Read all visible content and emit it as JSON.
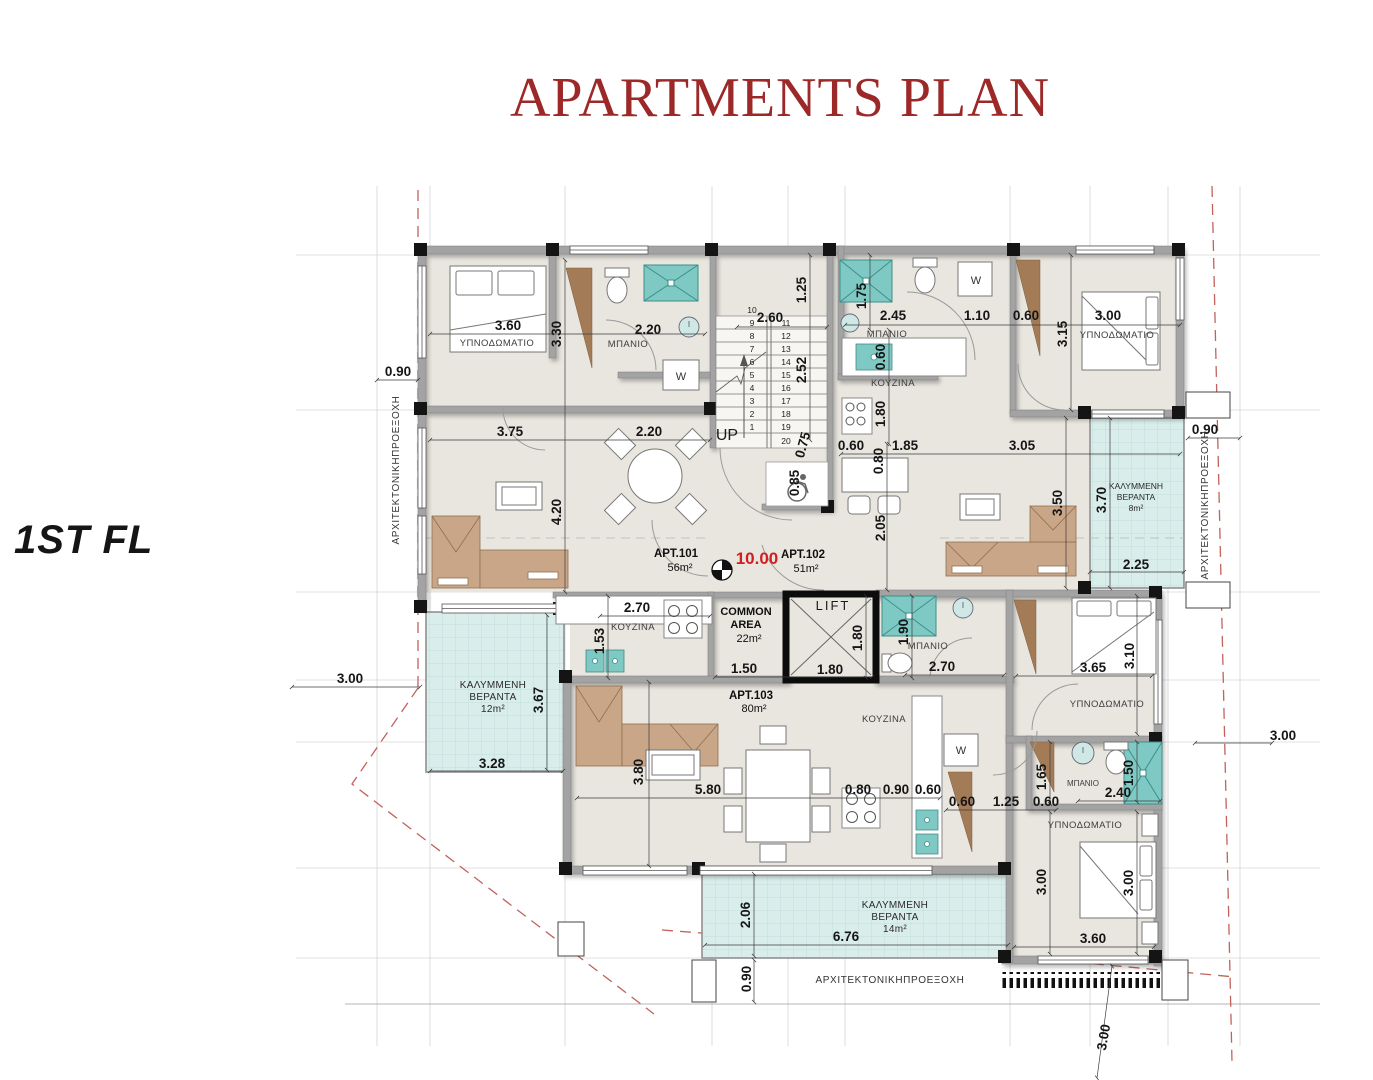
{
  "title": "APARTMENTS PLAN",
  "floor_label": "1ST FL",
  "colors": {
    "title_red": "#9d2828",
    "marker_red": "#cf1f1f",
    "boundary_red": "#c1625c",
    "floor": "#e9e6df",
    "wall": "#a3a3a3",
    "column": "#141414",
    "veranda": "#d9edeb",
    "fixture_teal": "#7fc9c4",
    "furniture_wood": "#c9a687",
    "wardrobe_brown": "#a37c57"
  },
  "apartments": [
    {
      "id": "APT.101",
      "area": "56m²"
    },
    {
      "id": "APT.102",
      "area": "51m²"
    },
    {
      "id": "APT.103",
      "area": "80m²"
    }
  ],
  "common_area": {
    "label": "COMMON AREA",
    "area": "22m²"
  },
  "lift_label": "LIFT",
  "level_marker": "10.00",
  "room_names": {
    "bedroom": "ΥΠΝΟΔΩΜΑΤΙΟ",
    "bathroom": "ΜΠΑΝΙΟ",
    "kitchen": "ΚΟΥΖΙΝΑ",
    "covered_veranda": "ΚΑΛΥΜΜΕΝΗ ΒΕΡΑΝΤΑ",
    "architectural_projection": "ΑΡΧΙΤΕΚΤΟΝΙΚΗΠΡΟΕΞΟΧΗ"
  },
  "verandas": [
    {
      "label": "ΚΑΛΥΜΜΕΝΗ ΒΕΡΑΝΤΑ",
      "area": "8m²"
    },
    {
      "label": "ΚΑΛΥΜΜΕΝΗ ΒΕΡΑΝΤΑ",
      "area": "12m²"
    },
    {
      "label": "ΚΑΛΥΜΜΕΝΗ ΒΕΡΑΝΤΑ",
      "area": "14m²"
    }
  ],
  "plan": {
    "stairs": {
      "up_label": "UP",
      "top": "10",
      "bottom": "20",
      "left": [
        "9",
        "8",
        "7",
        "6",
        "5",
        "4",
        "3",
        "2",
        "1"
      ],
      "right": [
        "11",
        "12",
        "13",
        "14",
        "15",
        "16",
        "17",
        "18",
        "19"
      ]
    },
    "annotations": [
      {
        "t": "3.60",
        "x": 508,
        "y": 330
      },
      {
        "t": "3.30",
        "x": 561,
        "y": 334,
        "r": -90
      },
      {
        "t": "2.20",
        "x": 648,
        "y": 334
      },
      {
        "t": "0.90",
        "x": 398,
        "y": 376
      },
      {
        "t": "2.60",
        "x": 770,
        "y": 322
      },
      {
        "t": "1.25",
        "x": 806,
        "y": 290,
        "r": -90
      },
      {
        "t": "2.52",
        "x": 806,
        "y": 370,
        "r": -90
      },
      {
        "t": "1.75",
        "x": 866,
        "y": 296,
        "r": -90
      },
      {
        "t": "2.45",
        "x": 893,
        "y": 320
      },
      {
        "t": "1.10",
        "x": 977,
        "y": 320
      },
      {
        "t": "0.60",
        "x": 1026,
        "y": 320
      },
      {
        "t": "3.00",
        "x": 1108,
        "y": 320
      },
      {
        "t": "3.15",
        "x": 1067,
        "y": 334,
        "r": -90
      },
      {
        "t": "0.60",
        "x": 885,
        "y": 357,
        "r": -90
      },
      {
        "t": "1.80",
        "x": 885,
        "y": 414,
        "r": -90
      },
      {
        "t": "3.75",
        "x": 510,
        "y": 436
      },
      {
        "t": "2.20",
        "x": 649,
        "y": 436
      },
      {
        "t": "0.60",
        "x": 851,
        "y": 450
      },
      {
        "t": "1.85",
        "x": 905,
        "y": 450
      },
      {
        "t": "3.05",
        "x": 1022,
        "y": 450
      },
      {
        "t": "0.90",
        "x": 1205,
        "y": 434
      },
      {
        "t": "0.75",
        "x": 807,
        "y": 446,
        "r": -75
      },
      {
        "t": "0.85",
        "x": 799,
        "y": 483,
        "r": -90
      },
      {
        "t": "0.80",
        "x": 883,
        "y": 461,
        "r": -90
      },
      {
        "t": "2.05",
        "x": 885,
        "y": 528,
        "r": -90
      },
      {
        "t": "4.20",
        "x": 561,
        "y": 512,
        "r": -90
      },
      {
        "t": "3.50",
        "x": 1062,
        "y": 503,
        "r": -90
      },
      {
        "t": "3.70",
        "x": 1106,
        "y": 500,
        "r": -90
      },
      {
        "t": "2.25",
        "x": 1136,
        "y": 569
      },
      {
        "t": "2.70",
        "x": 637,
        "y": 612
      },
      {
        "t": "1.53",
        "x": 604,
        "y": 641,
        "r": -90
      },
      {
        "t": "1.50",
        "x": 744,
        "y": 673
      },
      {
        "t": "1.80",
        "x": 830,
        "y": 674
      },
      {
        "t": "1.80",
        "x": 862,
        "y": 638,
        "r": -90
      },
      {
        "t": "1.90",
        "x": 908,
        "y": 632,
        "r": -90
      },
      {
        "t": "2.70",
        "x": 942,
        "y": 671
      },
      {
        "t": "3.65",
        "x": 1093,
        "y": 672
      },
      {
        "t": "3.10",
        "x": 1134,
        "y": 656,
        "r": -90
      },
      {
        "t": "3.00",
        "x": 350,
        "y": 683
      },
      {
        "t": "3.67",
        "x": 543,
        "y": 700,
        "r": -90
      },
      {
        "t": "3.28",
        "x": 492,
        "y": 768
      },
      {
        "t": "5.80",
        "x": 708,
        "y": 794
      },
      {
        "t": "3.80",
        "x": 643,
        "y": 772,
        "r": -90
      },
      {
        "t": "0.80",
        "x": 858,
        "y": 794
      },
      {
        "t": "0.90",
        "x": 896,
        "y": 794
      },
      {
        "t": "0.60",
        "x": 928,
        "y": 794
      },
      {
        "t": "0.60",
        "x": 962,
        "y": 806
      },
      {
        "t": "1.25",
        "x": 1006,
        "y": 806
      },
      {
        "t": "0.60",
        "x": 1046,
        "y": 806
      },
      {
        "t": "1.65",
        "x": 1046,
        "y": 777,
        "r": -90
      },
      {
        "t": "2.40",
        "x": 1118,
        "y": 797
      },
      {
        "t": "1.50",
        "x": 1133,
        "y": 773,
        "r": -90
      },
      {
        "t": "3.00",
        "x": 1046,
        "y": 882,
        "r": -90
      },
      {
        "t": "3.00",
        "x": 1133,
        "y": 883,
        "r": -90
      },
      {
        "t": "3.60",
        "x": 1093,
        "y": 943
      },
      {
        "t": "2.06",
        "x": 750,
        "y": 915,
        "r": -90
      },
      {
        "t": "6.76",
        "x": 846,
        "y": 941
      },
      {
        "t": "0.90",
        "x": 751,
        "y": 979,
        "r": -90
      },
      {
        "t": "3.00",
        "x": 1283,
        "y": 740
      },
      {
        "t": "3.00",
        "x": 1108,
        "y": 1038,
        "r": -80
      },
      {
        "t": "ΥΠΝΟΔΩΜΑΤΙΟ",
        "x": 497,
        "y": 346,
        "c": "room"
      },
      {
        "t": "ΜΠΑΝΙΟ",
        "x": 628,
        "y": 347,
        "c": "room"
      },
      {
        "t": "ΜΠΑΝΙΟ",
        "x": 887,
        "y": 337,
        "c": "room"
      },
      {
        "t": "ΚΟΥΖΙΝΑ",
        "x": 893,
        "y": 386,
        "c": "room"
      },
      {
        "t": "ΥΠΝΟΔΩΜΑΤΙΟ",
        "x": 1117,
        "y": 338,
        "c": "room"
      },
      {
        "t": "ΚΟΥΖΙΝΑ",
        "x": 633,
        "y": 630,
        "c": "room"
      },
      {
        "t": "ΜΠΑΝΙΟ",
        "x": 928,
        "y": 649,
        "c": "room"
      },
      {
        "t": "ΥΠΝΟΔΩΜΑΤΙΟ",
        "x": 1107,
        "y": 707,
        "c": "room"
      },
      {
        "t": "ΚΟΥΖΙΝΑ",
        "x": 884,
        "y": 722,
        "c": "room"
      },
      {
        "t": "ΜΠΑΝΙΟ",
        "x": 1083,
        "y": 786,
        "c": "room-s"
      },
      {
        "t": "ΥΠΝΟΔΩΜΑΤΙΟ",
        "x": 1085,
        "y": 828,
        "c": "room"
      },
      {
        "t": "APT.101",
        "x": 676,
        "y": 557,
        "c": "apt"
      },
      {
        "t": "56m²",
        "x": 680,
        "y": 571,
        "c": "aptarea"
      },
      {
        "t": "10.00",
        "x": 757,
        "y": 564,
        "c": "red"
      },
      {
        "t": "APT.102",
        "x": 803,
        "y": 558,
        "c": "apt"
      },
      {
        "t": "51m²",
        "x": 806,
        "y": 572,
        "c": "aptarea"
      },
      {
        "t": "APT.103",
        "x": 751,
        "y": 699,
        "c": "apt"
      },
      {
        "t": "80m²",
        "x": 754,
        "y": 712,
        "c": "aptarea"
      },
      {
        "t": "COMMON",
        "x": 746,
        "y": 615,
        "c": "common"
      },
      {
        "t": "AREA",
        "x": 746,
        "y": 628,
        "c": "common"
      },
      {
        "t": "22m²",
        "x": 749,
        "y": 642,
        "c": "aptarea"
      },
      {
        "t": "LIFT",
        "x": 833,
        "y": 610,
        "c": "lift"
      },
      {
        "t": "UP",
        "x": 727,
        "y": 440,
        "c": "up"
      },
      {
        "t": "ΚΑΛΥΜΜΕΝΗ",
        "x": 1136,
        "y": 489,
        "c": "ver-s"
      },
      {
        "t": "ΒΕΡΑΝΤΑ",
        "x": 1136,
        "y": 500,
        "c": "ver-s"
      },
      {
        "t": "8m²",
        "x": 1136,
        "y": 511,
        "c": "ver-s"
      },
      {
        "t": "ΚΑΛΥΜΜΕΝΗ",
        "x": 493,
        "y": 688,
        "c": "ver"
      },
      {
        "t": "ΒΕΡΑΝΤΑ",
        "x": 493,
        "y": 700,
        "c": "ver"
      },
      {
        "t": "12m²",
        "x": 493,
        "y": 712,
        "c": "ver"
      },
      {
        "t": "ΚΑΛΥΜΜΕΝΗ",
        "x": 895,
        "y": 908,
        "c": "ver"
      },
      {
        "t": "ΒΕΡΑΝΤΑ",
        "x": 895,
        "y": 920,
        "c": "ver"
      },
      {
        "t": "14m²",
        "x": 895,
        "y": 932,
        "c": "ver"
      },
      {
        "t": "ΑΡΧΙΤΕΚΤΟΝΙΚΗΠΡΟΕΞΟΧΗ",
        "x": 399,
        "y": 470,
        "r": -90,
        "c": "proj"
      },
      {
        "t": "ΑΡΧΙΤΕΚΤΟΝΙΚΗΠΡΟΕΞΟΧΗ",
        "x": 1208,
        "y": 505,
        "r": -90,
        "c": "proj"
      },
      {
        "t": "ΑΡΧΙΤΕΚΤΟΝΙΚΗΠΡΟΕΞΟΧΗ",
        "x": 890,
        "y": 983,
        "c": "proj"
      },
      {
        "t": "W",
        "x": 976,
        "y": 284,
        "c": "wlabel"
      },
      {
        "t": "W",
        "x": 681,
        "y": 380,
        "c": "wlabel"
      },
      {
        "t": "W",
        "x": 961,
        "y": 754,
        "c": "wlabel"
      }
    ]
  }
}
